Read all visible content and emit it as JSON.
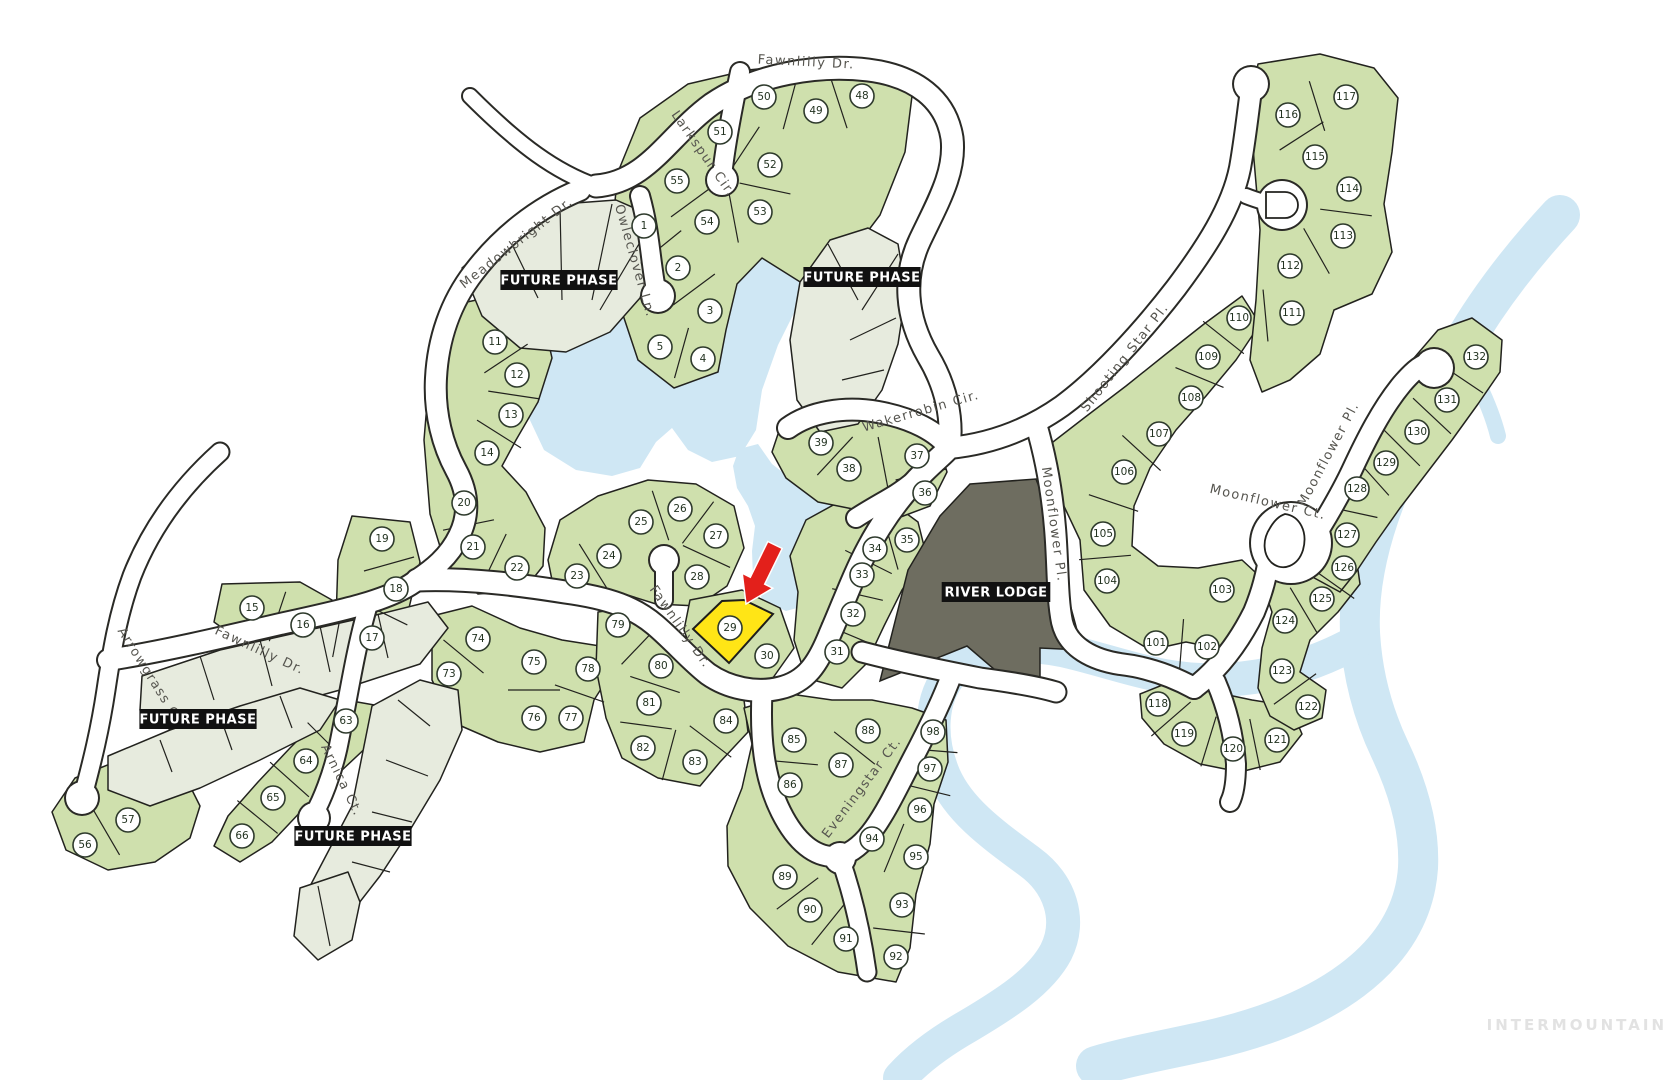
{
  "watermark": {
    "text": "INTERMOUNTAIN"
  },
  "colors": {
    "lot_green": "#cfe0ad",
    "future_pale": "#e7ebde",
    "water": "#cfe7f4",
    "lodge": "#6e6d60",
    "outline": "#22221e",
    "highlight_yellow": "#ffe516",
    "arrow_red": "#e3201b",
    "circle_fill": "#ffffff",
    "circle_stroke": "#2e3a2c"
  },
  "highlight": {
    "lot": "29"
  },
  "lodge_label": {
    "text": "RIVER LODGE",
    "x": 996,
    "y": 592
  },
  "area_labels": [
    {
      "text": "FUTURE PHASE",
      "x": 559,
      "y": 280
    },
    {
      "text": "FUTURE PHASE",
      "x": 862,
      "y": 277
    },
    {
      "text": "FUTURE PHASE",
      "x": 198,
      "y": 719
    },
    {
      "text": "FUTURE PHASE",
      "x": 353,
      "y": 836
    }
  ],
  "streets": [
    {
      "name": "Fawnlilly Dr.",
      "x": 806,
      "y": 66,
      "rot": 3
    },
    {
      "name": "Larkspur Cir.",
      "x": 700,
      "y": 156,
      "rot": 55
    },
    {
      "name": "Meadowbright Dr.",
      "x": 519,
      "y": 246,
      "rot": -38
    },
    {
      "name": "Owleclover Ln.",
      "x": 631,
      "y": 262,
      "rot": 74
    },
    {
      "name": "Wakerrobin Cir.",
      "x": 922,
      "y": 415,
      "rot": -16
    },
    {
      "name": "Shooting Star Pl.",
      "x": 1128,
      "y": 360,
      "rot": -52
    },
    {
      "name": "Moonflower Pl.",
      "x": 1050,
      "y": 525,
      "rot": 82
    },
    {
      "name": "Moonflower Ct.",
      "x": 1267,
      "y": 506,
      "rot": 13
    },
    {
      "name": "Moonflower Pl.",
      "x": 1332,
      "y": 456,
      "rot": -62
    },
    {
      "name": "Arrowgrass Ct.",
      "x": 148,
      "y": 680,
      "rot": 58
    },
    {
      "name": "Fawnlilly Dr.",
      "x": 258,
      "y": 654,
      "rot": 25
    },
    {
      "name": "Arnica Ct.",
      "x": 338,
      "y": 782,
      "rot": 64
    },
    {
      "name": "Fawnlilly Dr.",
      "x": 677,
      "y": 629,
      "rot": 55
    },
    {
      "name": "Eveningstar Ct.",
      "x": 865,
      "y": 790,
      "rot": -53
    }
  ],
  "lots": [
    {
      "n": "1",
      "x": 644,
      "y": 226
    },
    {
      "n": "2",
      "x": 678,
      "y": 268
    },
    {
      "n": "3",
      "x": 710,
      "y": 311
    },
    {
      "n": "4",
      "x": 703,
      "y": 359
    },
    {
      "n": "5",
      "x": 660,
      "y": 347
    },
    {
      "n": "11",
      "x": 495,
      "y": 342
    },
    {
      "n": "12",
      "x": 517,
      "y": 375
    },
    {
      "n": "13",
      "x": 511,
      "y": 415
    },
    {
      "n": "14",
      "x": 487,
      "y": 453
    },
    {
      "n": "15",
      "x": 252,
      "y": 608
    },
    {
      "n": "16",
      "x": 303,
      "y": 625
    },
    {
      "n": "17",
      "x": 372,
      "y": 638
    },
    {
      "n": "18",
      "x": 396,
      "y": 589
    },
    {
      "n": "19",
      "x": 382,
      "y": 539
    },
    {
      "n": "20",
      "x": 464,
      "y": 503
    },
    {
      "n": "21",
      "x": 473,
      "y": 547
    },
    {
      "n": "22",
      "x": 517,
      "y": 568
    },
    {
      "n": "23",
      "x": 577,
      "y": 576
    },
    {
      "n": "24",
      "x": 609,
      "y": 556
    },
    {
      "n": "25",
      "x": 641,
      "y": 522
    },
    {
      "n": "26",
      "x": 680,
      "y": 509
    },
    {
      "n": "27",
      "x": 716,
      "y": 536
    },
    {
      "n": "28",
      "x": 697,
      "y": 577
    },
    {
      "n": "29",
      "x": 730,
      "y": 628
    },
    {
      "n": "30",
      "x": 767,
      "y": 656
    },
    {
      "n": "31",
      "x": 837,
      "y": 652
    },
    {
      "n": "32",
      "x": 853,
      "y": 614
    },
    {
      "n": "33",
      "x": 862,
      "y": 575
    },
    {
      "n": "34",
      "x": 875,
      "y": 549
    },
    {
      "n": "35",
      "x": 907,
      "y": 540
    },
    {
      "n": "36",
      "x": 925,
      "y": 493
    },
    {
      "n": "37",
      "x": 917,
      "y": 456
    },
    {
      "n": "38",
      "x": 849,
      "y": 469
    },
    {
      "n": "39",
      "x": 821,
      "y": 443
    },
    {
      "n": "48",
      "x": 862,
      "y": 96
    },
    {
      "n": "49",
      "x": 816,
      "y": 111
    },
    {
      "n": "50",
      "x": 764,
      "y": 97
    },
    {
      "n": "51",
      "x": 720,
      "y": 132
    },
    {
      "n": "52",
      "x": 770,
      "y": 165
    },
    {
      "n": "53",
      "x": 760,
      "y": 212
    },
    {
      "n": "54",
      "x": 707,
      "y": 222
    },
    {
      "n": "55",
      "x": 677,
      "y": 181
    },
    {
      "n": "56",
      "x": 85,
      "y": 845
    },
    {
      "n": "57",
      "x": 128,
      "y": 820
    },
    {
      "n": "63",
      "x": 346,
      "y": 721
    },
    {
      "n": "64",
      "x": 306,
      "y": 761
    },
    {
      "n": "65",
      "x": 273,
      "y": 798
    },
    {
      "n": "66",
      "x": 242,
      "y": 836
    },
    {
      "n": "73",
      "x": 449,
      "y": 674
    },
    {
      "n": "74",
      "x": 478,
      "y": 639
    },
    {
      "n": "75",
      "x": 534,
      "y": 662
    },
    {
      "n": "76",
      "x": 534,
      "y": 718
    },
    {
      "n": "77",
      "x": 571,
      "y": 718
    },
    {
      "n": "78",
      "x": 588,
      "y": 669
    },
    {
      "n": "79",
      "x": 618,
      "y": 625
    },
    {
      "n": "80",
      "x": 661,
      "y": 666
    },
    {
      "n": "81",
      "x": 649,
      "y": 703
    },
    {
      "n": "82",
      "x": 643,
      "y": 748
    },
    {
      "n": "83",
      "x": 695,
      "y": 762
    },
    {
      "n": "84",
      "x": 726,
      "y": 721
    },
    {
      "n": "85",
      "x": 794,
      "y": 740
    },
    {
      "n": "86",
      "x": 790,
      "y": 785
    },
    {
      "n": "87",
      "x": 841,
      "y": 765
    },
    {
      "n": "88",
      "x": 868,
      "y": 731
    },
    {
      "n": "89",
      "x": 785,
      "y": 877
    },
    {
      "n": "90",
      "x": 810,
      "y": 910
    },
    {
      "n": "91",
      "x": 846,
      "y": 939
    },
    {
      "n": "92",
      "x": 896,
      "y": 957
    },
    {
      "n": "93",
      "x": 902,
      "y": 905
    },
    {
      "n": "94",
      "x": 872,
      "y": 839
    },
    {
      "n": "95",
      "x": 916,
      "y": 857
    },
    {
      "n": "96",
      "x": 920,
      "y": 810
    },
    {
      "n": "97",
      "x": 930,
      "y": 769
    },
    {
      "n": "98",
      "x": 933,
      "y": 732
    },
    {
      "n": "101",
      "x": 1156,
      "y": 643
    },
    {
      "n": "102",
      "x": 1207,
      "y": 647
    },
    {
      "n": "103",
      "x": 1222,
      "y": 590
    },
    {
      "n": "104",
      "x": 1107,
      "y": 581
    },
    {
      "n": "105",
      "x": 1103,
      "y": 534
    },
    {
      "n": "106",
      "x": 1124,
      "y": 472
    },
    {
      "n": "107",
      "x": 1159,
      "y": 434
    },
    {
      "n": "108",
      "x": 1191,
      "y": 398
    },
    {
      "n": "109",
      "x": 1208,
      "y": 357
    },
    {
      "n": "110",
      "x": 1239,
      "y": 318
    },
    {
      "n": "111",
      "x": 1292,
      "y": 313
    },
    {
      "n": "112",
      "x": 1290,
      "y": 266
    },
    {
      "n": "113",
      "x": 1343,
      "y": 236
    },
    {
      "n": "114",
      "x": 1349,
      "y": 189
    },
    {
      "n": "115",
      "x": 1315,
      "y": 157
    },
    {
      "n": "116",
      "x": 1288,
      "y": 115
    },
    {
      "n": "117",
      "x": 1346,
      "y": 97
    },
    {
      "n": "118",
      "x": 1158,
      "y": 704
    },
    {
      "n": "119",
      "x": 1184,
      "y": 734
    },
    {
      "n": "120",
      "x": 1233,
      "y": 749
    },
    {
      "n": "121",
      "x": 1277,
      "y": 740
    },
    {
      "n": "122",
      "x": 1308,
      "y": 707
    },
    {
      "n": "123",
      "x": 1282,
      "y": 671
    },
    {
      "n": "124",
      "x": 1285,
      "y": 621
    },
    {
      "n": "125",
      "x": 1322,
      "y": 599
    },
    {
      "n": "126",
      "x": 1344,
      "y": 568
    },
    {
      "n": "127",
      "x": 1347,
      "y": 535
    },
    {
      "n": "128",
      "x": 1357,
      "y": 489
    },
    {
      "n": "129",
      "x": 1386,
      "y": 463
    },
    {
      "n": "130",
      "x": 1417,
      "y": 432
    },
    {
      "n": "131",
      "x": 1447,
      "y": 400
    },
    {
      "n": "132",
      "x": 1476,
      "y": 357
    }
  ],
  "dividers": [
    [
      "50",
      "49"
    ],
    [
      "49",
      "48"
    ],
    [
      "51",
      "52"
    ],
    [
      "55",
      "54"
    ],
    [
      "54",
      "53"
    ],
    [
      "52",
      "53"
    ],
    [
      "1",
      "2"
    ],
    [
      "2",
      "3"
    ],
    [
      "5",
      "4"
    ],
    [
      "11",
      "12"
    ],
    [
      "12",
      "13"
    ],
    [
      "13",
      "14"
    ],
    [
      "20",
      "21"
    ],
    [
      "21",
      "22"
    ],
    [
      "15",
      "16"
    ],
    [
      "16",
      "17"
    ],
    [
      "19",
      "18"
    ],
    [
      "18",
      "17"
    ],
    [
      "25",
      "26"
    ],
    [
      "26",
      "27"
    ],
    [
      "24",
      "23"
    ],
    [
      "28",
      "27"
    ],
    [
      "31",
      "32"
    ],
    [
      "32",
      "33"
    ],
    [
      "33",
      "34"
    ],
    [
      "34",
      "35"
    ],
    [
      "36",
      "37"
    ],
    [
      "38",
      "39"
    ],
    [
      "37",
      "38"
    ],
    [
      "73",
      "74"
    ],
    [
      "75",
      "76"
    ],
    [
      "77",
      "78"
    ],
    [
      "79",
      "80"
    ],
    [
      "80",
      "81"
    ],
    [
      "81",
      "82"
    ],
    [
      "82",
      "83"
    ],
    [
      "83",
      "84"
    ],
    [
      "85",
      "86"
    ],
    [
      "87",
      "88"
    ],
    [
      "97",
      "98"
    ],
    [
      "96",
      "97"
    ],
    [
      "95",
      "94"
    ],
    [
      "93",
      "92"
    ],
    [
      "90",
      "91"
    ],
    [
      "89",
      "90"
    ],
    [
      "63",
      "64"
    ],
    [
      "64",
      "65"
    ],
    [
      "65",
      "66"
    ],
    [
      "56",
      "57"
    ],
    [
      "101",
      "102"
    ],
    [
      "104",
      "105"
    ],
    [
      "105",
      "106"
    ],
    [
      "106",
      "107"
    ],
    [
      "108",
      "109"
    ],
    [
      "109",
      "110"
    ],
    [
      "110",
      "111"
    ],
    [
      "112",
      "113"
    ],
    [
      "113",
      "114"
    ],
    [
      "115",
      "116"
    ],
    [
      "116",
      "117"
    ],
    [
      "118",
      "119"
    ],
    [
      "119",
      "120"
    ],
    [
      "120",
      "121"
    ],
    [
      "122",
      "123"
    ],
    [
      "124",
      "125"
    ],
    [
      "125",
      "126"
    ],
    [
      "127",
      "128"
    ],
    [
      "128",
      "129"
    ],
    [
      "129",
      "130"
    ],
    [
      "130",
      "131"
    ],
    [
      "131",
      "132"
    ]
  ]
}
